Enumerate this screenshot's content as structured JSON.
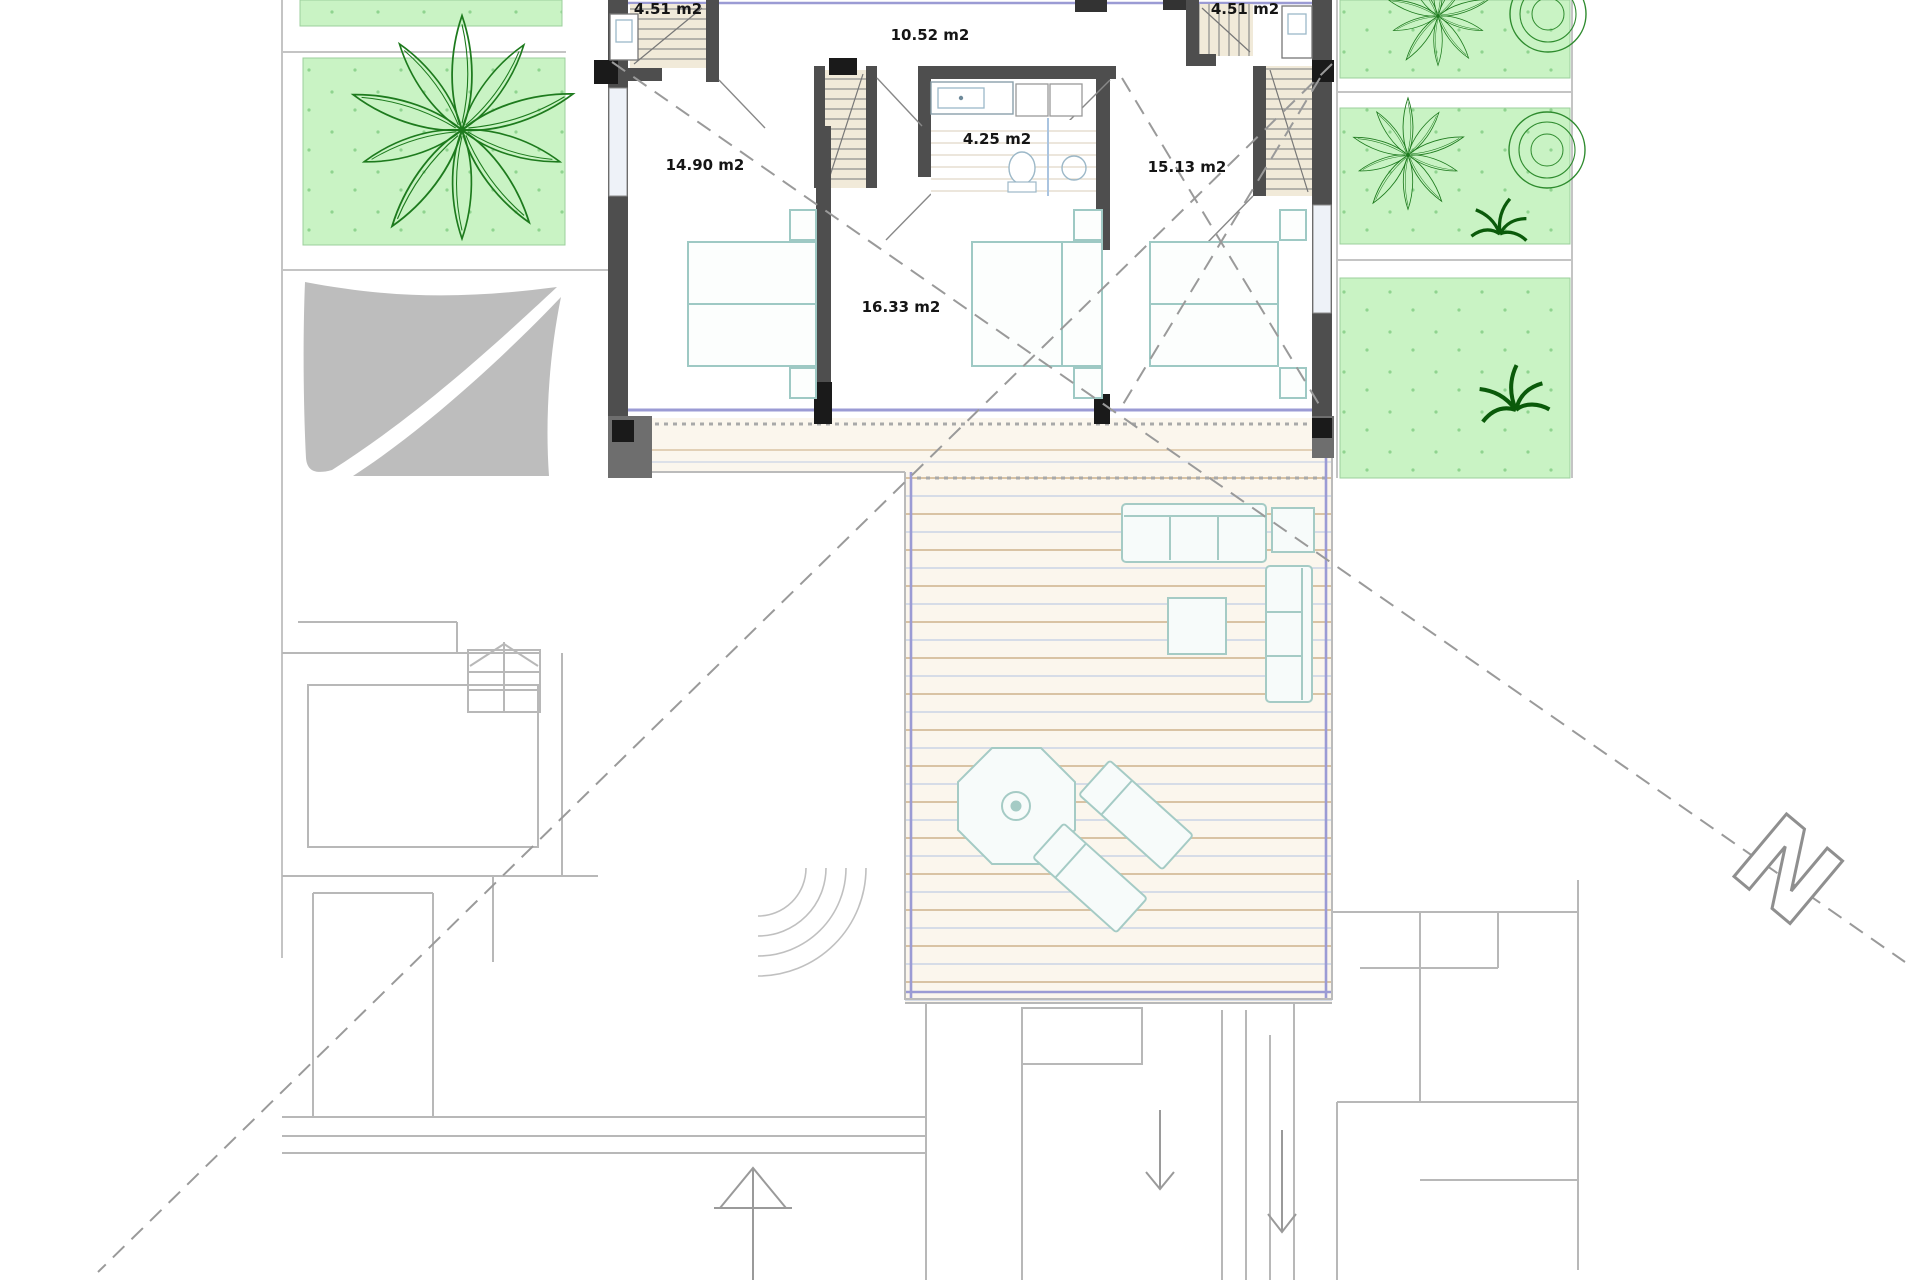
{
  "plan": {
    "type": "floor-plan-upper-level",
    "north_label": "N",
    "rooms": [
      {
        "name": "stair-room-left",
        "area_label": "4.51 m2"
      },
      {
        "name": "landing",
        "area_label": "10.52 m2"
      },
      {
        "name": "stair-room-right",
        "area_label": "4.51 m2"
      },
      {
        "name": "bedroom-left",
        "area_label": "14.90 m2"
      },
      {
        "name": "bathroom",
        "area_label": "4.25 m2"
      },
      {
        "name": "bedroom-right",
        "area_label": "15.13 m2"
      },
      {
        "name": "hall",
        "area_label": "16.33 m2"
      }
    ],
    "colors": {
      "garden_green": "#c9f3c4",
      "plant_green": "#1d7a1d",
      "dark_plant_green": "#0a5a0a",
      "wall_gray": "#4e4e4e",
      "column_black": "#1a1a1a",
      "sail_gray": "#bdbdbd",
      "glass_lavender": "#9b9bd4",
      "deck_board_tan": "#d9c3a4",
      "deck_board_blue": "#c9d4e5",
      "deck_bg_cream": "#fbf6ed",
      "furniture_teal": "#a5cbc5",
      "site_line_gray": "#b8b8b8",
      "dashed_line_gray": "#9a9a9a"
    }
  }
}
